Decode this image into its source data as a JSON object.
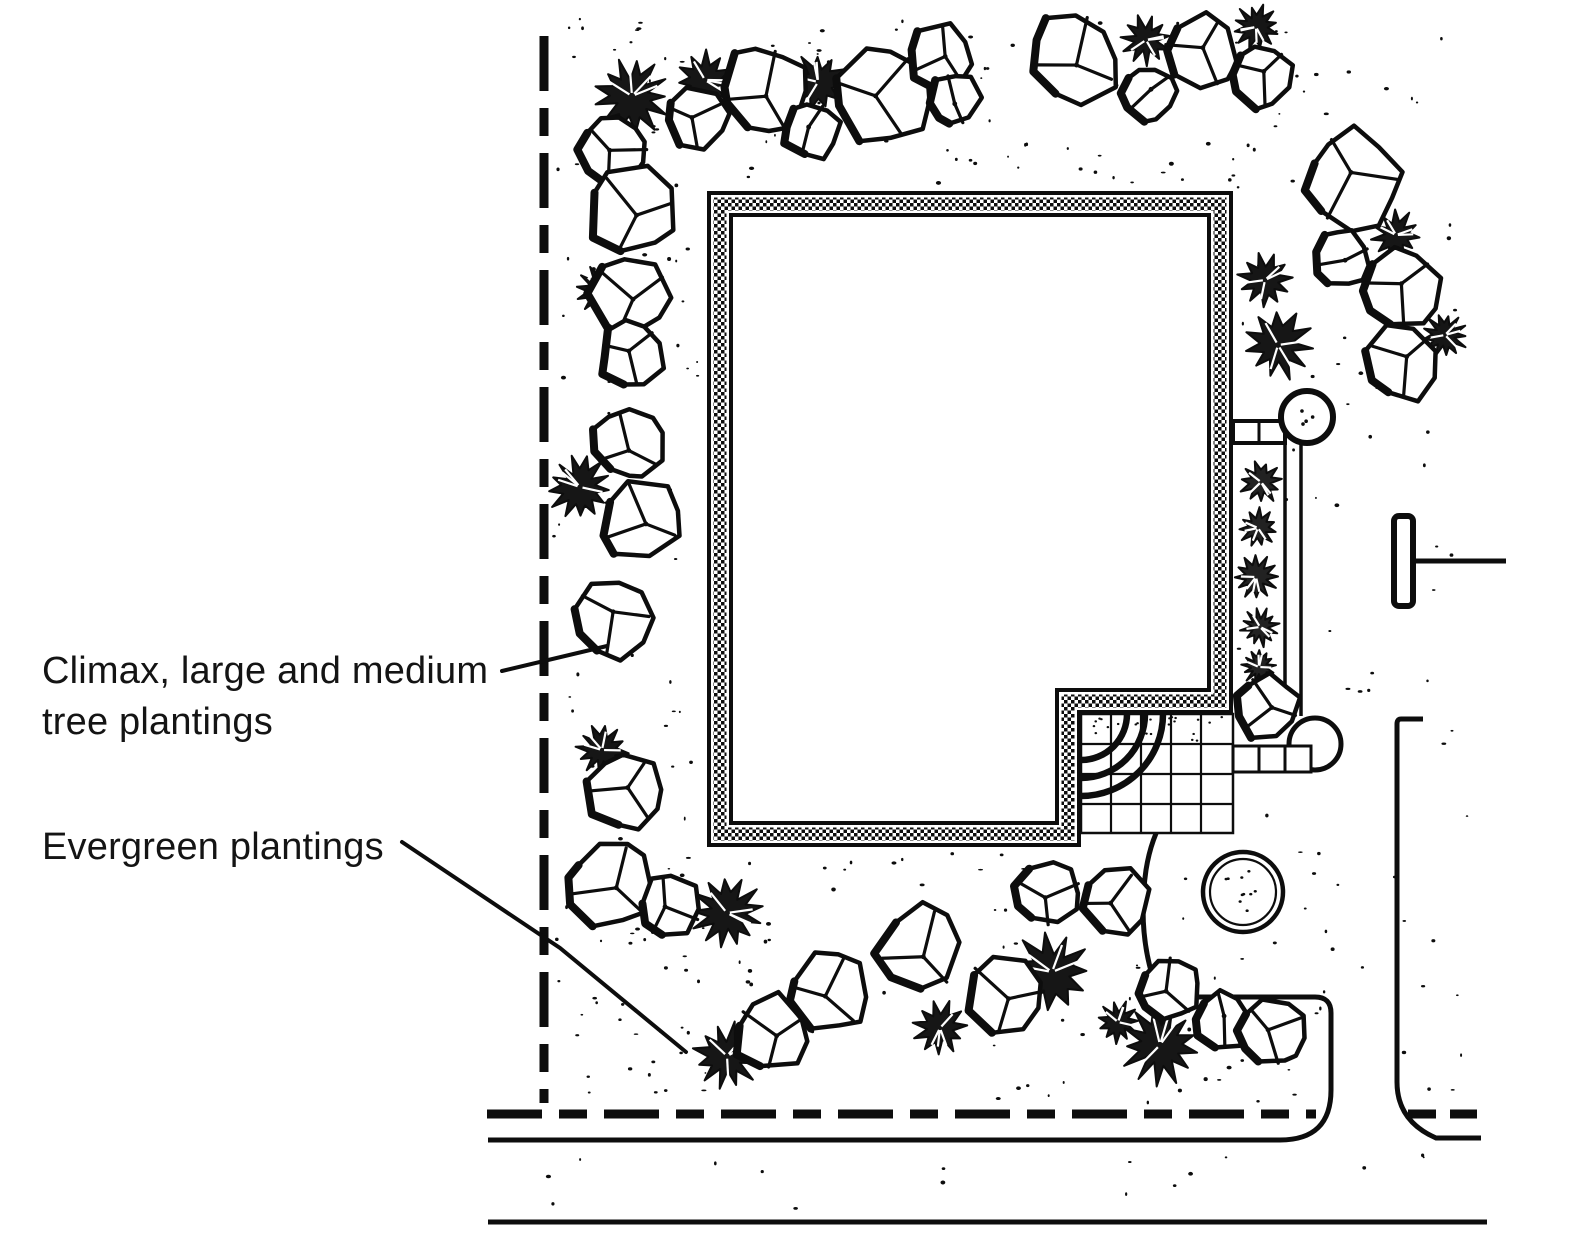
{
  "canvas": {
    "width": 1569,
    "height": 1242,
    "background": "#ffffff",
    "ink": "#0d0d0d"
  },
  "annotations": {
    "climax": {
      "line1": "Climax, large and medium",
      "line2": "tree plantings",
      "x": 42,
      "y": 646,
      "leader": "M 502 671 L 607 646"
    },
    "evergreen": {
      "line1": "Evergreen plantings",
      "x": 42,
      "y": 822,
      "leader": "M 402 842 L 560 948 L 686 1052"
    }
  },
  "property_lines": {
    "stroke_px": 9,
    "dash": "55 17 28 17",
    "segments": [
      {
        "x1": 544,
        "y1": 36,
        "x2": 544,
        "y2": 1103
      },
      {
        "x1": 487,
        "y1": 1114,
        "x2": 1316,
        "y2": 1114
      },
      {
        "x1": 1408,
        "y1": 1114,
        "x2": 1477,
        "y2": 1114,
        "dash": "28 14"
      }
    ]
  },
  "streets": {
    "stroke_px": 5,
    "paths": [
      "M 488 1140 H 1280 Q 1331 1140 1331 1090 L 1331 1013 Q 1331 997 1315 997 L 1160 997",
      "M 1160 997 Q 1136 940 1146 870 Q 1156 806 1204 778",
      "M 1423 719 H 1401 Q 1397 719 1397 724 L 1397 1082 Q 1397 1121 1436 1138 L 1481 1138",
      "M 488 1222 H 1487"
    ]
  },
  "mailbox": {
    "x": 1394,
    "y": 516,
    "w": 19,
    "h": 90,
    "arm_x2": 1506,
    "arm_y": 561
  },
  "building": {
    "outline": [
      [
        720,
        204
      ],
      [
        1220,
        204
      ],
      [
        1220,
        701
      ],
      [
        1068,
        701
      ],
      [
        1068,
        834
      ],
      [
        720,
        834
      ]
    ],
    "band_px": [
      26,
      18,
      13
    ],
    "checker_px": 7
  },
  "entry_court": {
    "x1": 1081,
    "y1": 714,
    "x2": 1233,
    "y2": 833,
    "grid_px": 30,
    "arc_radii": [
      46,
      64,
      82
    ],
    "speckle_count": 26
  },
  "paver_walk": {
    "row": {
      "x1": 1233,
      "y1": 746,
      "x2": 1311,
      "y2": 772,
      "dividers": [
        1259,
        1285
      ]
    },
    "bulge": {
      "cx": 1315,
      "cy": 744,
      "r": 26
    },
    "connector": {
      "x1": 1233,
      "y1": 421,
      "x2": 1285,
      "y2": 443,
      "divider": 1259
    },
    "bulb": {
      "cx": 1307,
      "cy": 417,
      "r": 26,
      "dots": 4
    },
    "fence_x": [
      1285,
      1301
    ],
    "fence_y1": 441,
    "fence_y2": 716
  },
  "apron_circle": {
    "cx": 1243,
    "cy": 892,
    "r_outer": 40,
    "r_inner": 33,
    "dots": 10
  },
  "planting": {
    "trees": [
      [
        615,
        150,
        36
      ],
      [
        697,
        117,
        34
      ],
      [
        763,
        90,
        46
      ],
      [
        812,
        130,
        30
      ],
      [
        883,
        95,
        50
      ],
      [
        940,
        58,
        36
      ],
      [
        953,
        100,
        28
      ],
      [
        632,
        210,
        46
      ],
      [
        628,
        295,
        44
      ],
      [
        632,
        355,
        34
      ],
      [
        628,
        445,
        37
      ],
      [
        641,
        520,
        42
      ],
      [
        612,
        618,
        42
      ],
      [
        625,
        793,
        40
      ],
      [
        610,
        885,
        46
      ],
      [
        670,
        908,
        34
      ],
      [
        772,
        1032,
        40
      ],
      [
        830,
        992,
        42
      ],
      [
        922,
        950,
        46
      ],
      [
        1005,
        993,
        44
      ],
      [
        1048,
        893,
        36
      ],
      [
        1116,
        903,
        36
      ],
      [
        1170,
        988,
        34
      ],
      [
        1222,
        1020,
        30
      ],
      [
        1273,
        1032,
        36
      ],
      [
        1267,
        706,
        34
      ],
      [
        1075,
        58,
        48
      ],
      [
        1149,
        93,
        28
      ],
      [
        1200,
        53,
        40
      ],
      [
        1262,
        76,
        33
      ],
      [
        1353,
        180,
        52
      ],
      [
        1342,
        257,
        30
      ],
      [
        1400,
        290,
        43
      ],
      [
        1404,
        362,
        40
      ]
    ],
    "evergreens": [
      [
        632,
        96,
        38
      ],
      [
        705,
        80,
        30
      ],
      [
        818,
        82,
        28
      ],
      [
        602,
        290,
        26
      ],
      [
        580,
        487,
        32
      ],
      [
        602,
        750,
        26
      ],
      [
        727,
        913,
        36
      ],
      [
        727,
        1056,
        33
      ],
      [
        940,
        1028,
        26
      ],
      [
        1052,
        972,
        40
      ],
      [
        1118,
        1022,
        22
      ],
      [
        1160,
        1045,
        38
      ],
      [
        1146,
        40,
        25
      ],
      [
        1256,
        27,
        22
      ],
      [
        1396,
        235,
        24
      ],
      [
        1445,
        335,
        22
      ],
      [
        1265,
        280,
        27
      ],
      [
        1278,
        345,
        35
      ]
    ],
    "shrubs": [
      [
        1261,
        482,
        21
      ],
      [
        1258,
        528,
        19
      ],
      [
        1256,
        577,
        21
      ],
      [
        1260,
        627,
        19
      ],
      [
        1259,
        667,
        17
      ]
    ]
  },
  "stipple": {
    "seed": 13,
    "regions": [
      {
        "x1": 552,
        "y1": 18,
        "x2": 1310,
        "y2": 185,
        "n": 90
      },
      {
        "x1": 552,
        "y1": 185,
        "x2": 704,
        "y2": 1100,
        "n": 70
      },
      {
        "x1": 1237,
        "y1": 18,
        "x2": 1468,
        "y2": 1100,
        "n": 85
      },
      {
        "x1": 552,
        "y1": 852,
        "x2": 1328,
        "y2": 1103,
        "n": 110
      },
      {
        "x1": 520,
        "y1": 1152,
        "x2": 1470,
        "y2": 1212,
        "n": 16
      }
    ],
    "exclusions": {
      "building": [
        707,
        191,
        1233,
        847
      ],
      "court_notch": [
        1081,
        714,
        1233,
        847
      ],
      "driveway": [
        1327,
        985,
        1401,
        1142
      ]
    }
  }
}
